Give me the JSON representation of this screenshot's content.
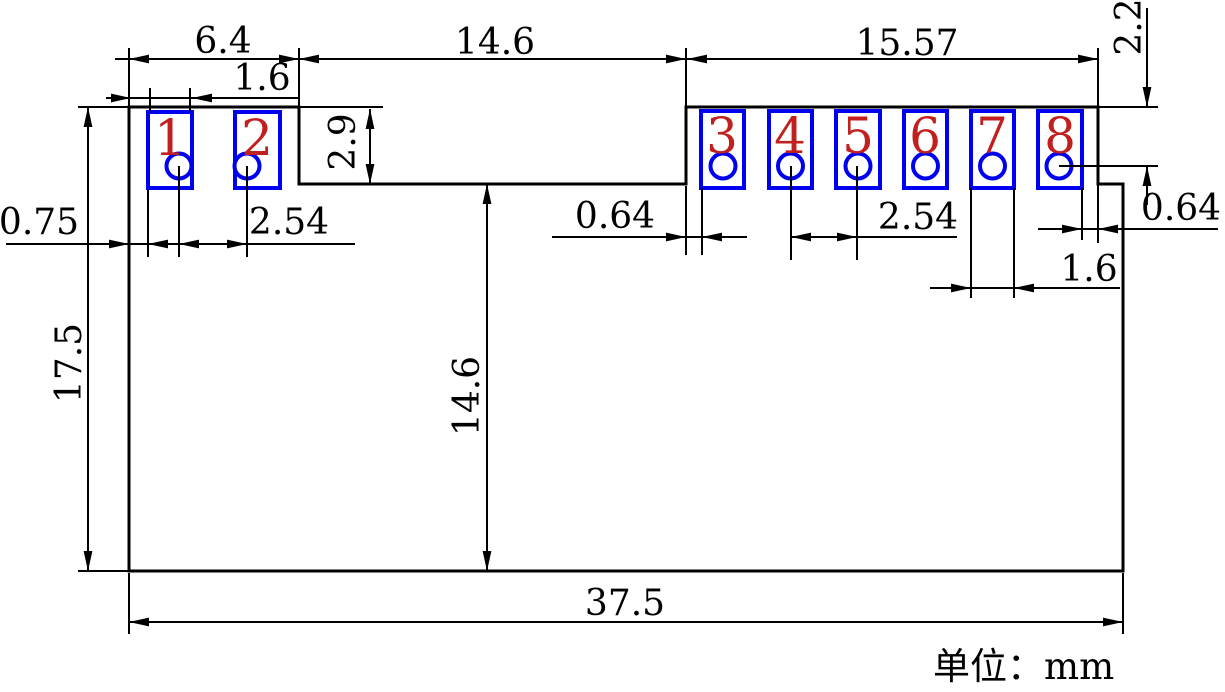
{
  "pads": [
    {
      "number": "1"
    },
    {
      "number": "2"
    },
    {
      "number": "3"
    },
    {
      "number": "4"
    },
    {
      "number": "5"
    },
    {
      "number": "6"
    },
    {
      "number": "7"
    },
    {
      "number": "8"
    },
    {
      "number": "8"
    }
  ],
  "dims": {
    "left_section_width": "6.4",
    "middle_gap_width": "14.6",
    "right_section_width": "15.57",
    "pad_width_left": "1.6",
    "left_edge_to_pad1": "0.75",
    "pad_pitch_left": "2.54",
    "tab_edge_to_pad3": "0.64",
    "pad_pitch_right": "2.54",
    "pad_width_right": "1.6",
    "pad8_to_tab_edge": "0.64",
    "top_to_hole_center": "2.2",
    "pad_section_height": "2.9",
    "overall_height": "17.5",
    "lower_section_height": "14.6",
    "overall_width": "37.5"
  },
  "note": "单位：mm",
  "colors": {
    "line": "#000000",
    "pad_outline": "#0000f0",
    "pad_number": "#c21f1f",
    "background": "#ffffff"
  }
}
